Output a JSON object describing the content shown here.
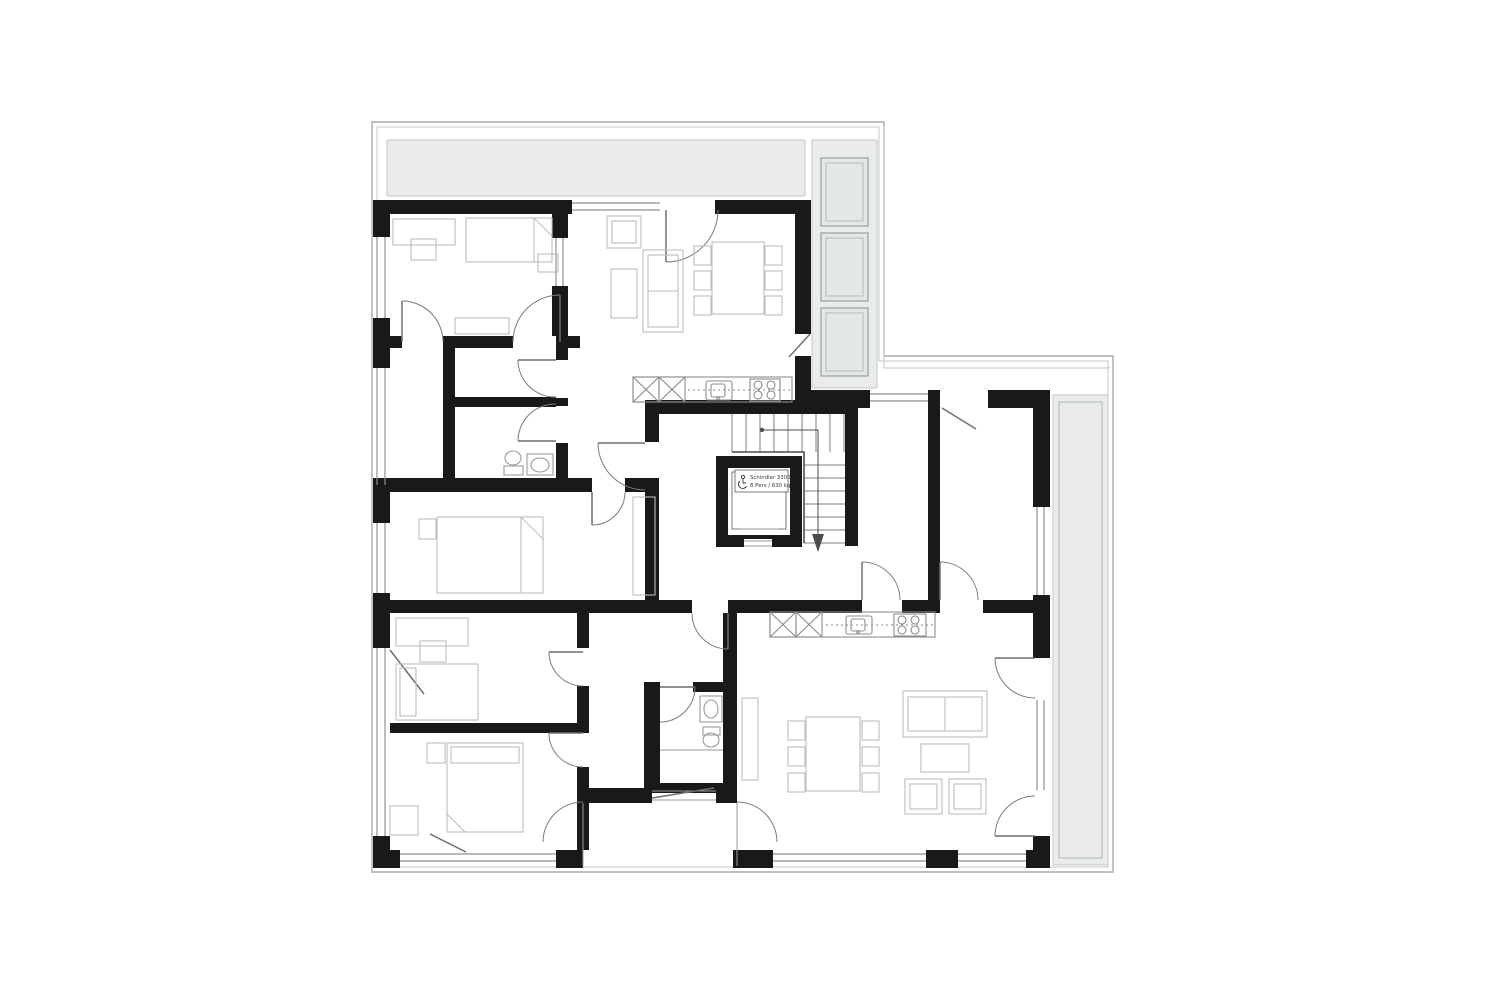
{
  "plan": {
    "elevator": {
      "line1": "Schindler 3300",
      "line2": "8 Pers / 630 kg"
    },
    "stair_direction": "down"
  },
  "colors": {
    "wall": "#191919",
    "terrace": "#e9ecea",
    "panel": "#e3e8e5",
    "background": "#ffffff"
  }
}
